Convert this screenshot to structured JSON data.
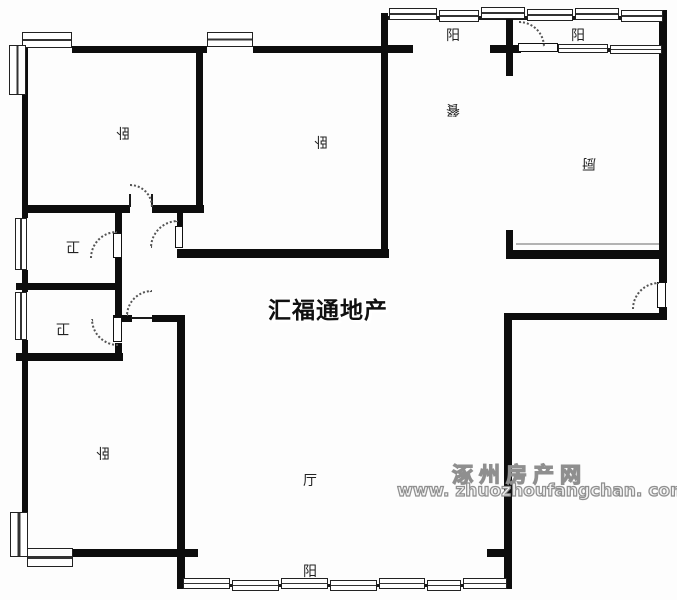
{
  "plan_title": "apartment-floor-plan",
  "rooms": [
    {
      "id": "bedroom-top-left",
      "label": "卧"
    },
    {
      "id": "bedroom-top-middle",
      "label": "卧"
    },
    {
      "id": "bedroom-bottom-left",
      "label": "卧"
    },
    {
      "id": "bathroom-upper",
      "label": "卫"
    },
    {
      "id": "bathroom-lower",
      "label": "卫"
    },
    {
      "id": "living-room",
      "label": "厅"
    },
    {
      "id": "dining-room",
      "label": "餐"
    },
    {
      "id": "kitchen",
      "label": "厨"
    },
    {
      "id": "balcony-top-left",
      "label": "阳"
    },
    {
      "id": "balcony-top-right",
      "label": "阳"
    },
    {
      "id": "balcony-bottom",
      "label": "阳"
    }
  ],
  "watermarks": {
    "center": "汇福通地产",
    "site_name": "涿州房产网",
    "site_url": "www. zhuozhoufangchan. com"
  },
  "colors": {
    "wall": "#0d0d0d",
    "room_label": "#222222",
    "center_watermark": "#101010",
    "hollow_watermark_outline": "#8f8f8f"
  }
}
